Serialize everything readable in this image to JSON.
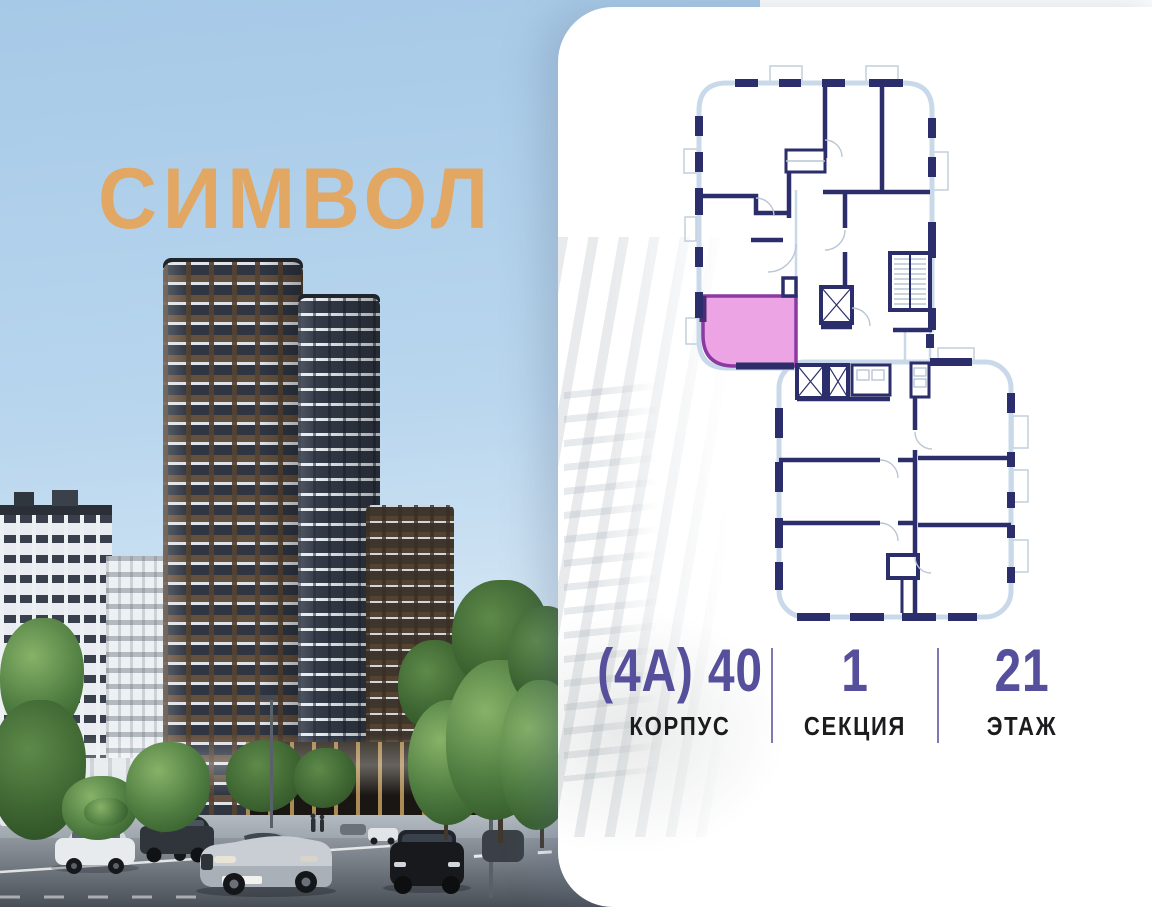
{
  "logo": {
    "text": "СИМВОЛ"
  },
  "unit_info": {
    "items": [
      {
        "value": "(4А) 40",
        "label": "КОРПУС"
      },
      {
        "value": "1",
        "label": "СЕКЦИЯ"
      },
      {
        "value": "21",
        "label": "ЭТАЖ"
      }
    ]
  },
  "floorplan": {
    "selected_unit": "highlighted-apartment",
    "blocks_shown": 2
  },
  "colors": {
    "info_value": "#564f9c",
    "info_label": "#1c1c1e",
    "divider": "#6a60a8",
    "plan_wall": "#2b2e6b",
    "plan_outline": "#c9d9ea",
    "plan_detail": "#b9c6d4",
    "highlight_fill": "#eda4e4",
    "highlight_border": "#8a3aa0",
    "logo": "#e2a763",
    "sky_top": "#a6c9e7",
    "panel": "#ffffff"
  }
}
